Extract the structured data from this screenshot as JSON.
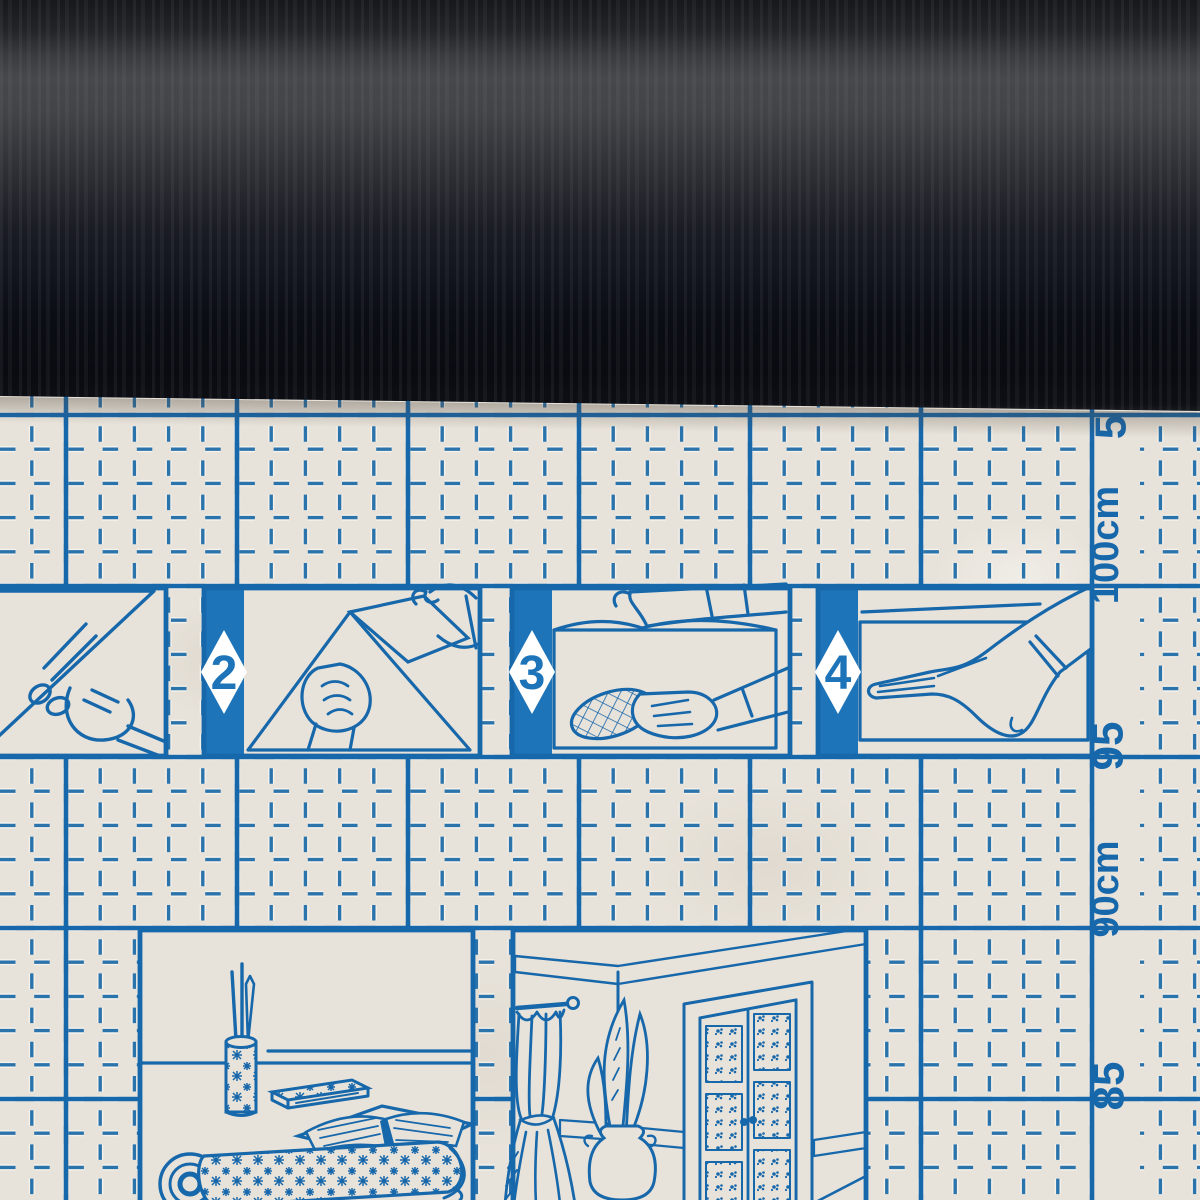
{
  "product": {
    "scene": "roll of dark self-adhesive film unrolled over its printed backing paper"
  },
  "ruler": {
    "labels": [
      {
        "text": "5"
      },
      {
        "text": "100cm"
      },
      {
        "text": "95"
      },
      {
        "text": "90cm"
      },
      {
        "text": "85"
      }
    ]
  },
  "steps": {
    "panel_numbers": [
      {
        "number": "2"
      },
      {
        "number": "3"
      },
      {
        "number": "4"
      }
    ]
  },
  "colors": {
    "ink": "#1767ab",
    "grid": "#2b73ab",
    "bar": "#1e74b8",
    "paper": "#e8e3da",
    "roll_dark": "#0b0d14",
    "roll_highlight": "#47484c"
  }
}
